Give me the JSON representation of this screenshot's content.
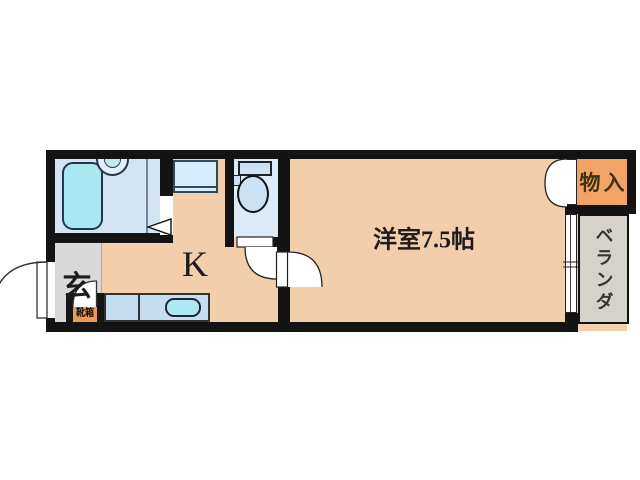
{
  "floorplan": {
    "labels": {
      "main_room": "洋室7.5帖",
      "kitchen": "K",
      "entrance": "玄",
      "closet": "物入",
      "veranda": "ベランダ",
      "shoe_box": "靴箱"
    },
    "colors": {
      "wall": "#131313",
      "floor_tan": "#f2cfaa",
      "closet_orange": "#f1a464",
      "shoebox_orange": "#ee9a4e",
      "bath_blue": "#d5e4f3",
      "toilet_blue": "#dcebf7",
      "fixture_blue": "#cce1f4",
      "tub_cyan": "#aae9f1",
      "counter_blue": "#c6def2",
      "sink_cyan": "#ace9f2",
      "entrance_gray": "#d9d9d9",
      "veranda_gray": "#d6d2c9"
    }
  }
}
